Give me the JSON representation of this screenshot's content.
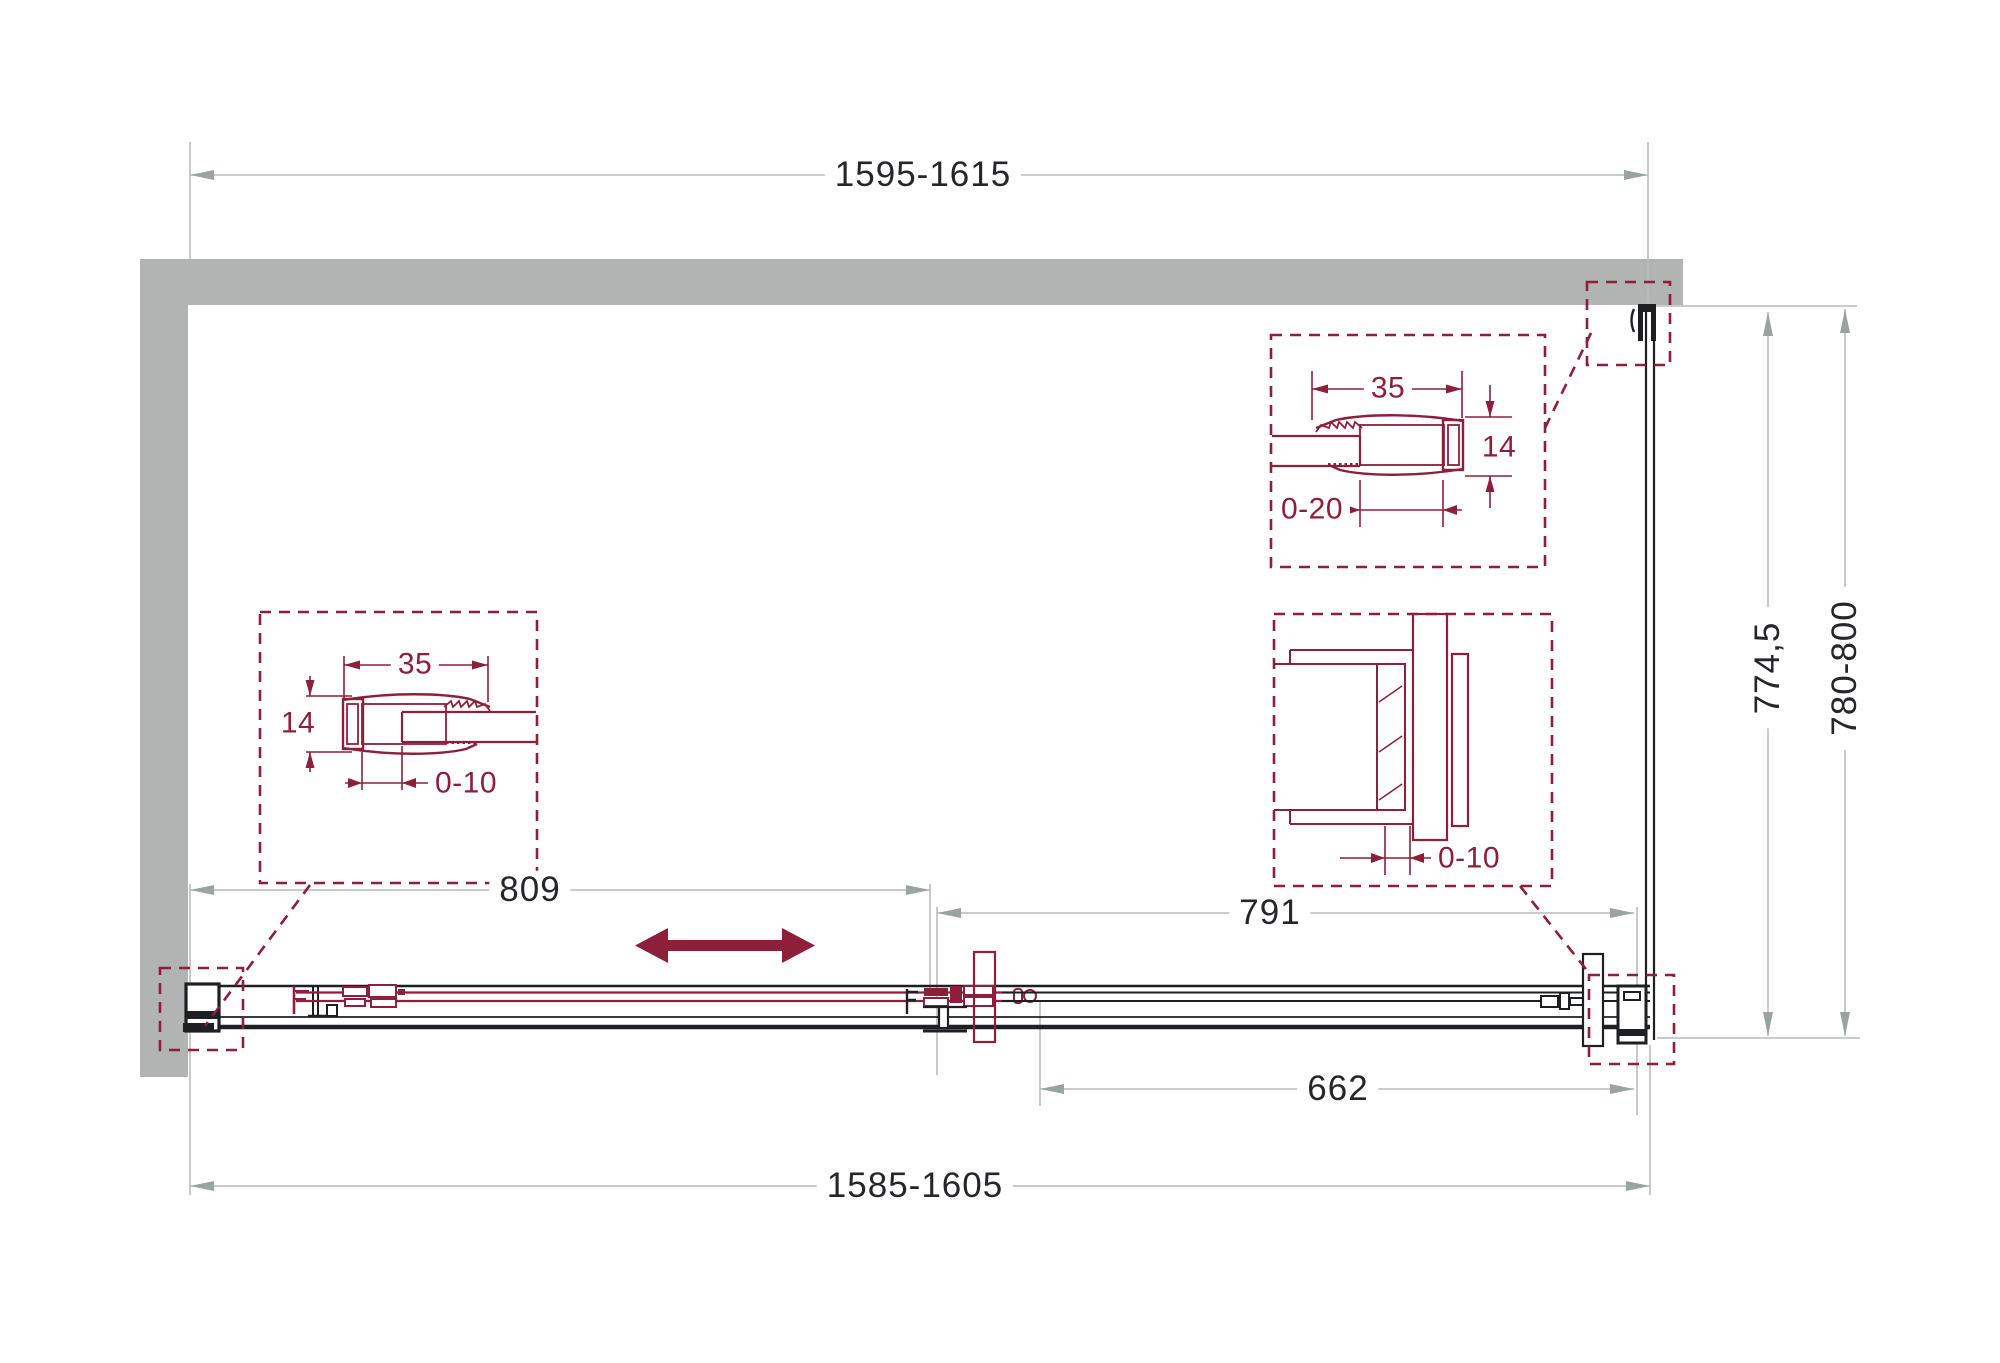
{
  "dimensions": {
    "top_width": "1595-1615",
    "bottom_width": "1585-1605",
    "door_panel_width": "809",
    "fixed_panel_width": "791",
    "side_return_width": "662",
    "depth_inner": "774,5",
    "depth_outer": "780-800"
  },
  "details": {
    "left_wall_profile": {
      "profile_width": "35",
      "profile_depth": "14",
      "adjustment": "0-10"
    },
    "right_wall_profile": {
      "profile_width": "35",
      "profile_depth": "14",
      "adjustment": "0-20"
    },
    "corner_connector": {
      "adjustment": "0-10"
    }
  },
  "colors": {
    "wall_gray": "#b1b4b3",
    "dimension_line_gray": "#b9bcbb",
    "dimension_arrow_gray": "#9aa3a2",
    "line_black": "#1d1f22",
    "accent_red": "#8e1f3a"
  },
  "icons": {
    "slide_direction": "double-arrow"
  }
}
